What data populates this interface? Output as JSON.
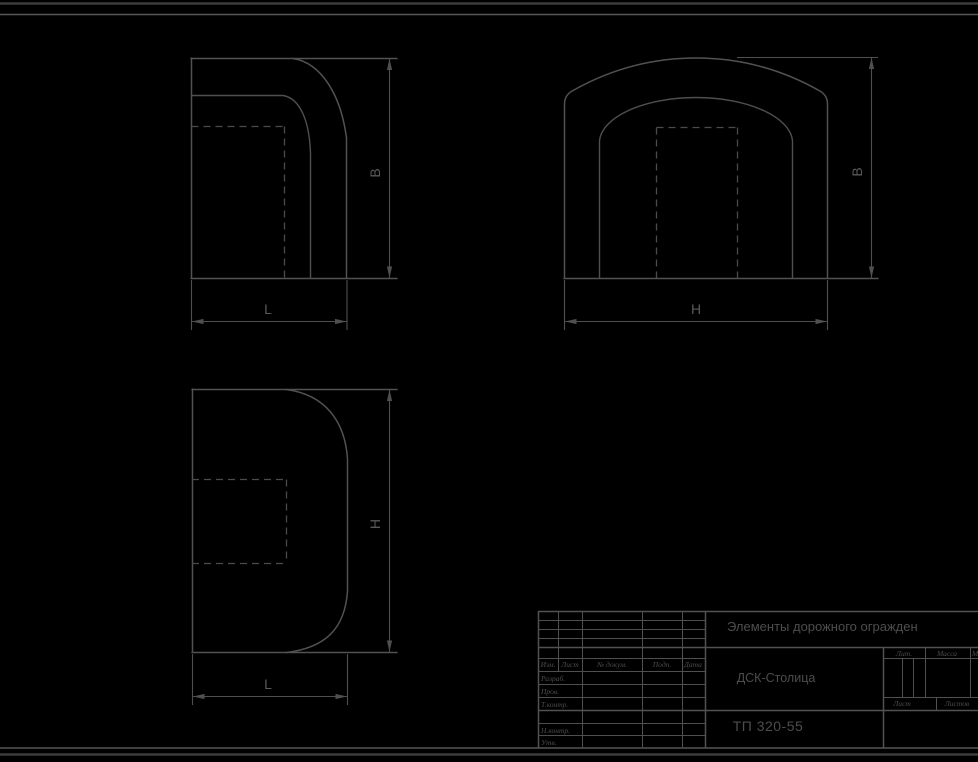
{
  "drawing": {
    "type": "engineering-drawing",
    "views": [
      {
        "id": "side-view",
        "position": "top-left",
        "width_dim": "L",
        "height_dim": "B"
      },
      {
        "id": "front-view",
        "position": "top-right",
        "width_dim": "H",
        "height_dim": "B"
      },
      {
        "id": "plan-view",
        "position": "bottom-left",
        "width_dim": "L",
        "height_dim": "H"
      }
    ]
  },
  "dimension_labels": {
    "b": "B",
    "h": "H",
    "l": "L"
  },
  "title_block": {
    "project_title": "Элементы дорожного огражден",
    "company": "ДСК-Столица",
    "doc_number": "ТП 320-55",
    "revision_header": {
      "izm": "Изм.",
      "list": "Лист",
      "doc": "№ докум.",
      "podp": "Подп.",
      "data": "Дата"
    },
    "signature_rows": {
      "razrab": "Разраб.",
      "prov": "Пров.",
      "tkontr": "Т.контр.",
      "nkontr": "Н.контр.",
      "utv": "Утв."
    },
    "right_panel": {
      "lit": "Лит.",
      "massa": "Масса",
      "masshtab": "Масштаб",
      "list": "Лист",
      "listov": "Листов"
    }
  },
  "colors": {
    "background": "#000000",
    "line": "#525252",
    "text": "#4d4d4d"
  }
}
